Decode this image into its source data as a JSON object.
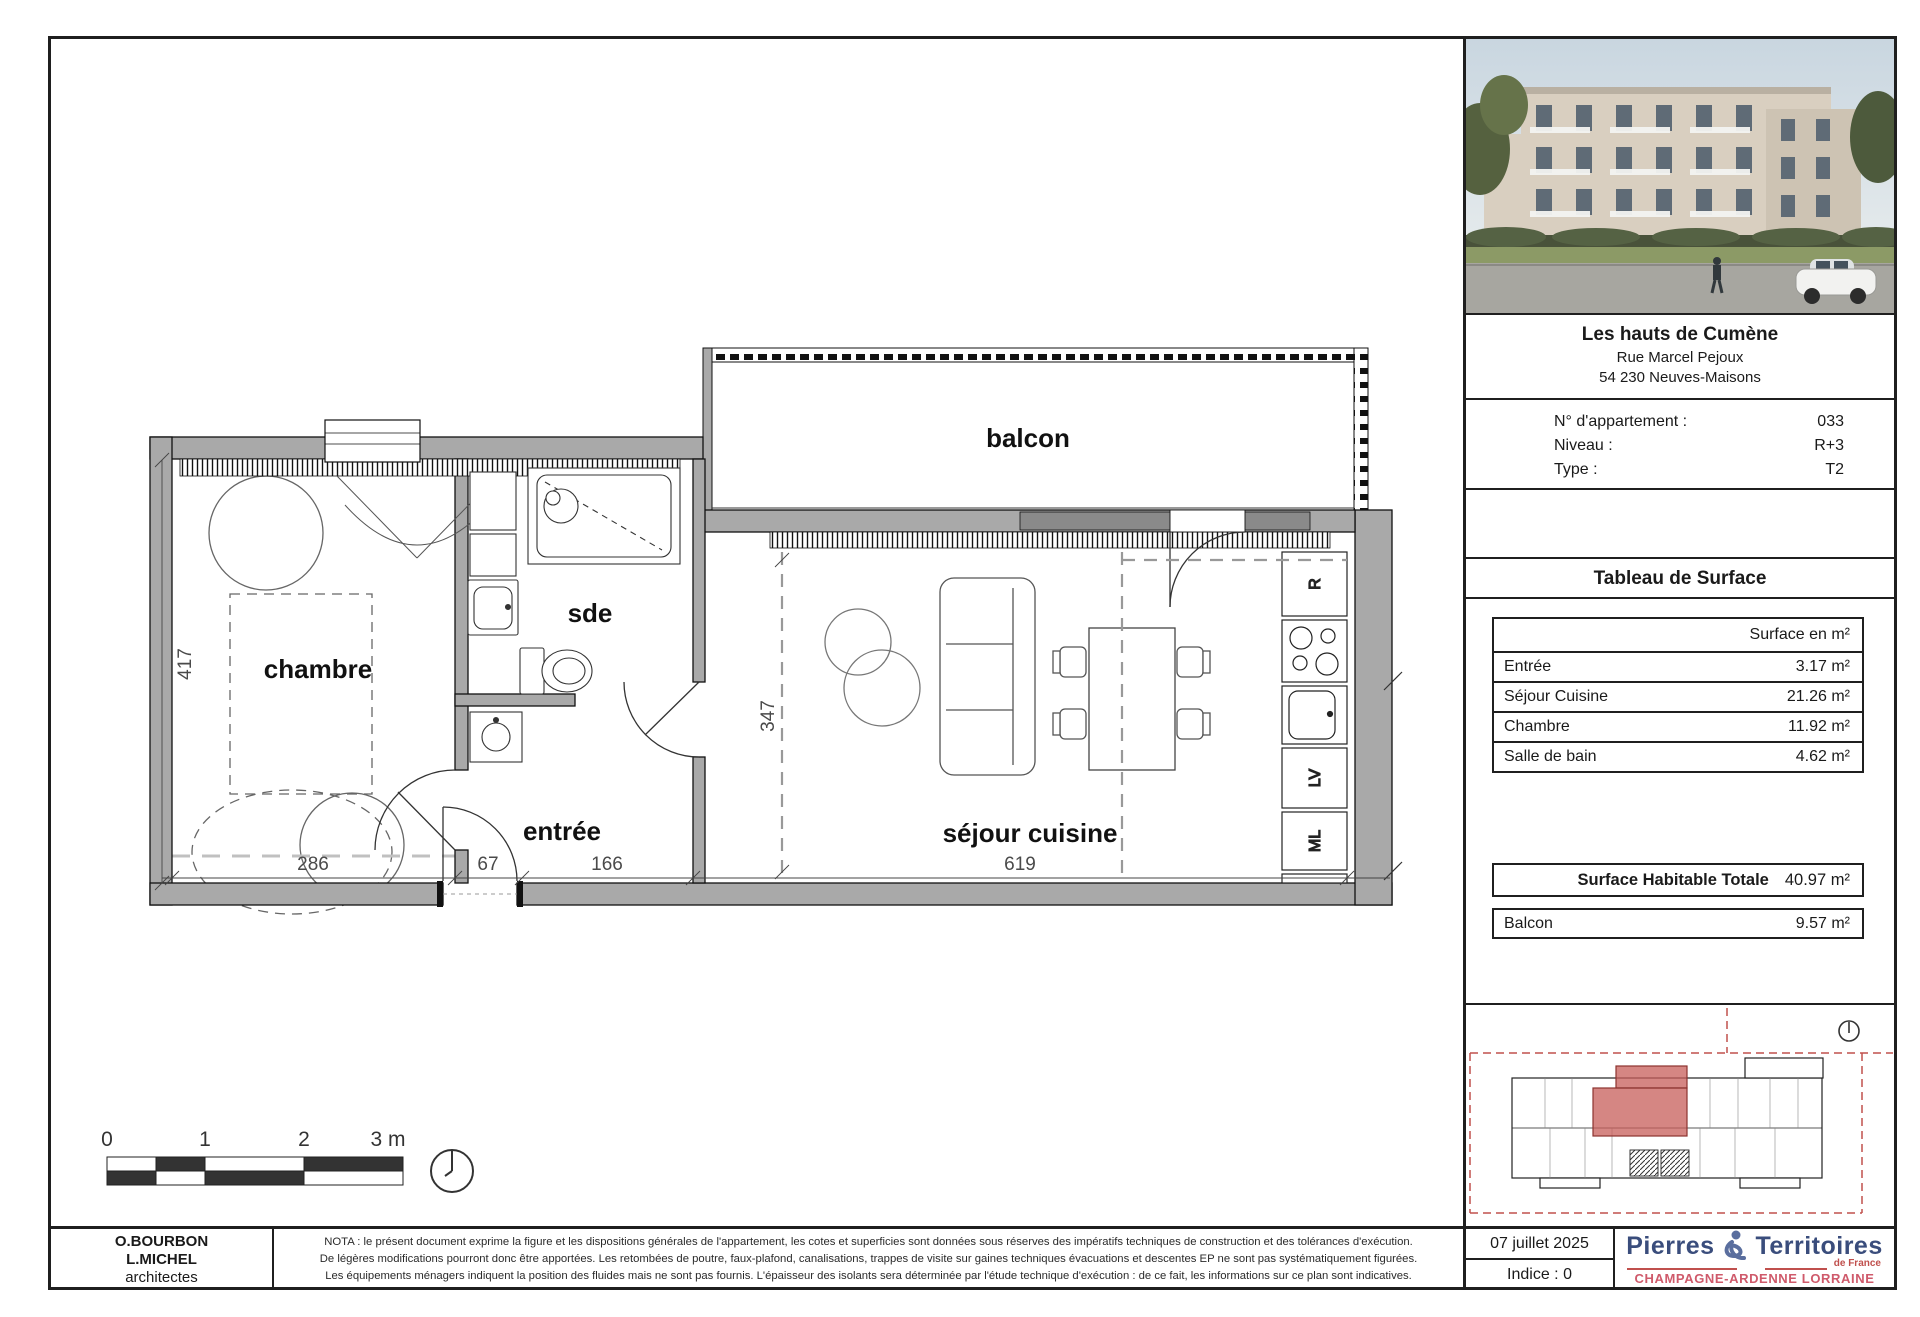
{
  "plan": {
    "labels": {
      "balcon": "balcon",
      "chambre": "chambre",
      "sde": "sde",
      "entree": "entrée",
      "sejour": "séjour cuisine"
    },
    "dimensions": {
      "chambre_height": "417",
      "chambre_width": "286",
      "closet": "67",
      "entree_width": "166",
      "sejour_width": "619",
      "sejour_height": "347"
    },
    "appliances": {
      "fridge": "R",
      "dishwasher": "LV",
      "washer": "ML"
    },
    "scalebar": {
      "t0": "0",
      "t1": "1",
      "t2": "2",
      "t3": "3 m"
    }
  },
  "panel": {
    "project": {
      "name": "Les hauts de Cumène",
      "street": "Rue Marcel Pejoux",
      "city": "54 230 Neuves-Maisons"
    },
    "info": {
      "apartment_label": "N° d'appartement :",
      "apartment_value": "033",
      "level_label": "Niveau :",
      "level_value": "R+3",
      "type_label": "Type :",
      "type_value": "T2"
    },
    "surface": {
      "title": "Tableau de Surface",
      "unit_header": "Surface en m²",
      "rows": [
        {
          "label": "Entrée",
          "value": "3.17 m²"
        },
        {
          "label": "Séjour Cuisine",
          "value": "21.26 m²"
        },
        {
          "label": "Chambre",
          "value": "11.92 m²"
        },
        {
          "label": "Salle de bain",
          "value": "4.62 m²"
        }
      ],
      "total_label": "Surface Habitable Totale",
      "total_value": "40.97 m²",
      "balcony_label": "Balcon",
      "balcony_value": "9.57 m²"
    }
  },
  "footer": {
    "architects": {
      "line1": "O.BOURBON",
      "line2": "L.MICHEL",
      "line3": "architectes"
    },
    "nota": {
      "line1": "NOTA : le présent document exprime la figure et les dispositions générales de l'appartement, les cotes et superficies sont données sous réserves des impératifs techniques de construction et des tolérances d'exécution.",
      "line2": "De légères modifications pourront donc être apportées. Les retombées de poutre, faux-plafond, canalisations, trappes de visite sur gaines techniques évacuations et descentes EP ne sont pas systématiquement figurées.",
      "line3": "Les équipements ménagers indiquent la position des fluides mais ne sont pas fournis. L'épaisseur des isolants sera déterminée par l'étude technique d'exécution : de ce fait, les informations sur ce plan sont indicatives."
    },
    "date": "07 juillet 2025",
    "index": "Indice : 0",
    "logo": {
      "brand1": "Pierres",
      "brand2": "Territoires",
      "sub": "de France",
      "region": "CHAMPAGNE-ARDENNE LORRAINE"
    }
  },
  "colors": {
    "accent_red": "#c0504d",
    "logo_blue": "#3a4d7c",
    "logo_red": "#cf5a6b",
    "wall_gray": "#a9a9a9"
  }
}
